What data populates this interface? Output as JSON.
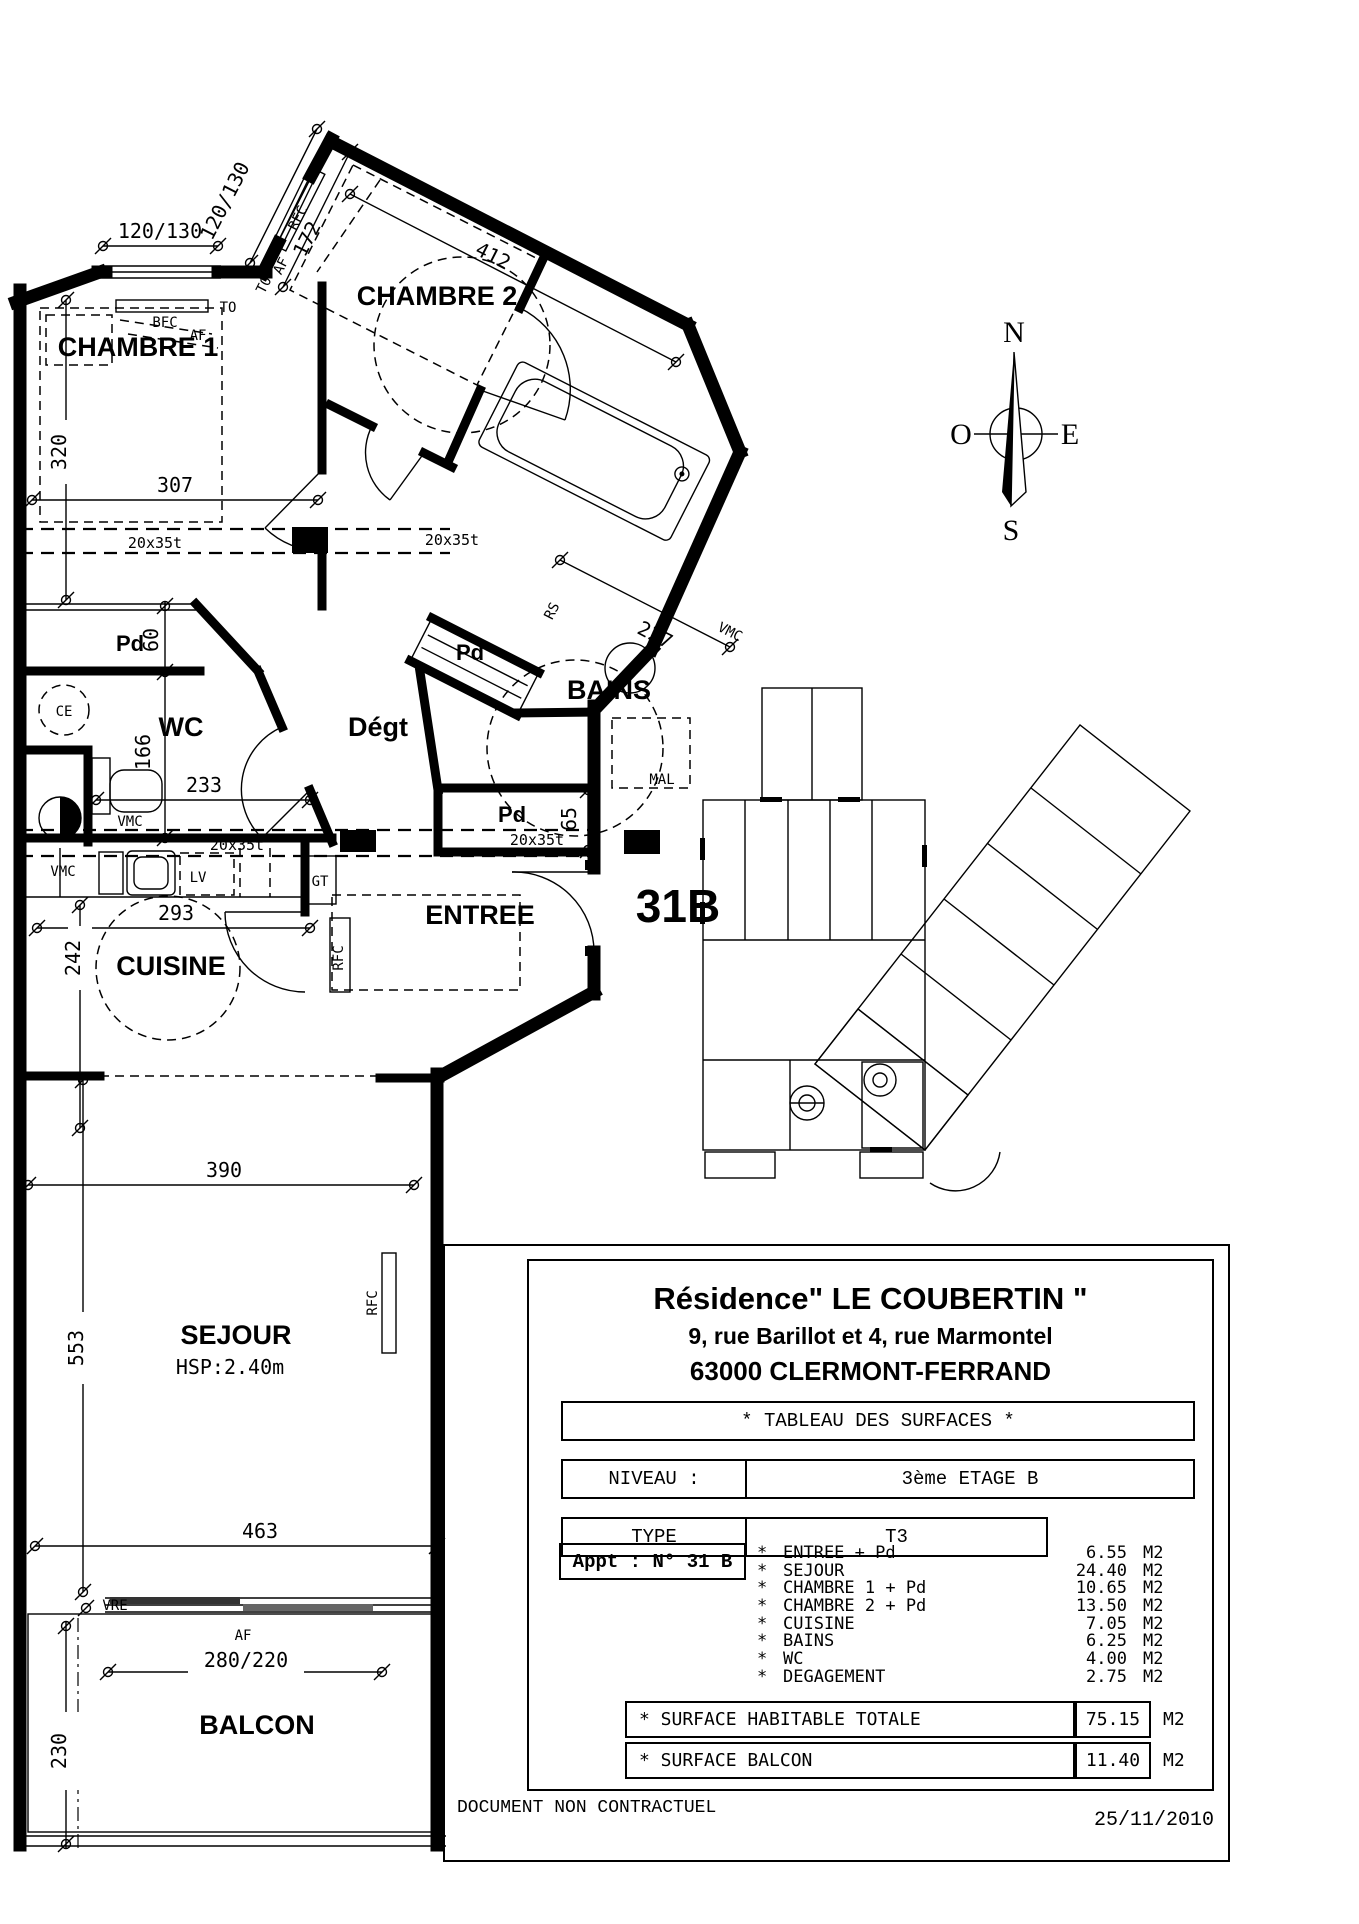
{
  "document": {
    "notice": "DOCUMENT NON CONTRACTUEL",
    "date": "25/11/2010"
  },
  "title_block": {
    "residence": "Résidence\" LE COUBERTIN \"",
    "address": "9, rue Barillot et 4, rue Marmontel",
    "city": "63000 CLERMONT-FERRAND",
    "surfaces_header": "* TABLEAU DES SURFACES *",
    "niveau_label": "NIVEAU :",
    "niveau_value": "3ème ETAGE B",
    "type_label": "TYPE",
    "type_value": "T3",
    "appt_label": "Appt : N° 31 B",
    "bullet": "*",
    "rooms": [
      {
        "label": "ENTREE + Pd",
        "value": "6.55",
        "unit": "M2"
      },
      {
        "label": "SEJOUR",
        "value": "24.40",
        "unit": "M2"
      },
      {
        "label": "CHAMBRE 1 + Pd",
        "value": "10.65",
        "unit": "M2"
      },
      {
        "label": "CHAMBRE 2 + Pd",
        "value": "13.50",
        "unit": "M2"
      },
      {
        "label": "CUISINE",
        "value": "7.05",
        "unit": "M2"
      },
      {
        "label": "BAINS",
        "value": "6.25",
        "unit": "M2"
      },
      {
        "label": "WC",
        "value": "4.00",
        "unit": "M2"
      },
      {
        "label": "DEGAGEMENT",
        "value": "2.75",
        "unit": "M2"
      }
    ],
    "totals": [
      {
        "label": "* SURFACE HABITABLE TOTALE",
        "value": "75.15",
        "unit": "M2"
      },
      {
        "label": "* SURFACE BALCON",
        "value": "11.40",
        "unit": "M2"
      }
    ]
  },
  "plan": {
    "apartment_number": "31B",
    "rooms": {
      "chambre1": "CHAMBRE 1",
      "chambre2": "CHAMBRE 2",
      "wc": "WC",
      "degagement": "Dégt",
      "bains": "BAINS",
      "cuisine": "CUISINE",
      "entree": "ENTREE",
      "sejour": "SEJOUR",
      "sejour_height": "HSP:2.40m",
      "balcon": "BALCON",
      "closet": "Pd"
    },
    "dims": {
      "d320": "320",
      "d307": "307",
      "window_small": "120/130",
      "d172": "172",
      "d412": "412",
      "d60": "60",
      "d166": "166",
      "d233": "233",
      "d227": "227",
      "d65": "65",
      "d293": "293",
      "d242": "242",
      "d390": "390",
      "d553": "553",
      "d463": "463",
      "balcony_window": "280/220",
      "d230": "230",
      "beam": "20x35t"
    },
    "notes": {
      "bfc": "BFC",
      "af": "AF",
      "to": "TO",
      "rfc": "RFC",
      "ce": "CE",
      "vmc": "VMC",
      "lv": "LV",
      "gt": "GT",
      "mal": "MAL",
      "vre": "VRE",
      "rs": "RS"
    }
  },
  "compass": {
    "north": "N",
    "south": "S",
    "east": "E",
    "west": "O"
  }
}
